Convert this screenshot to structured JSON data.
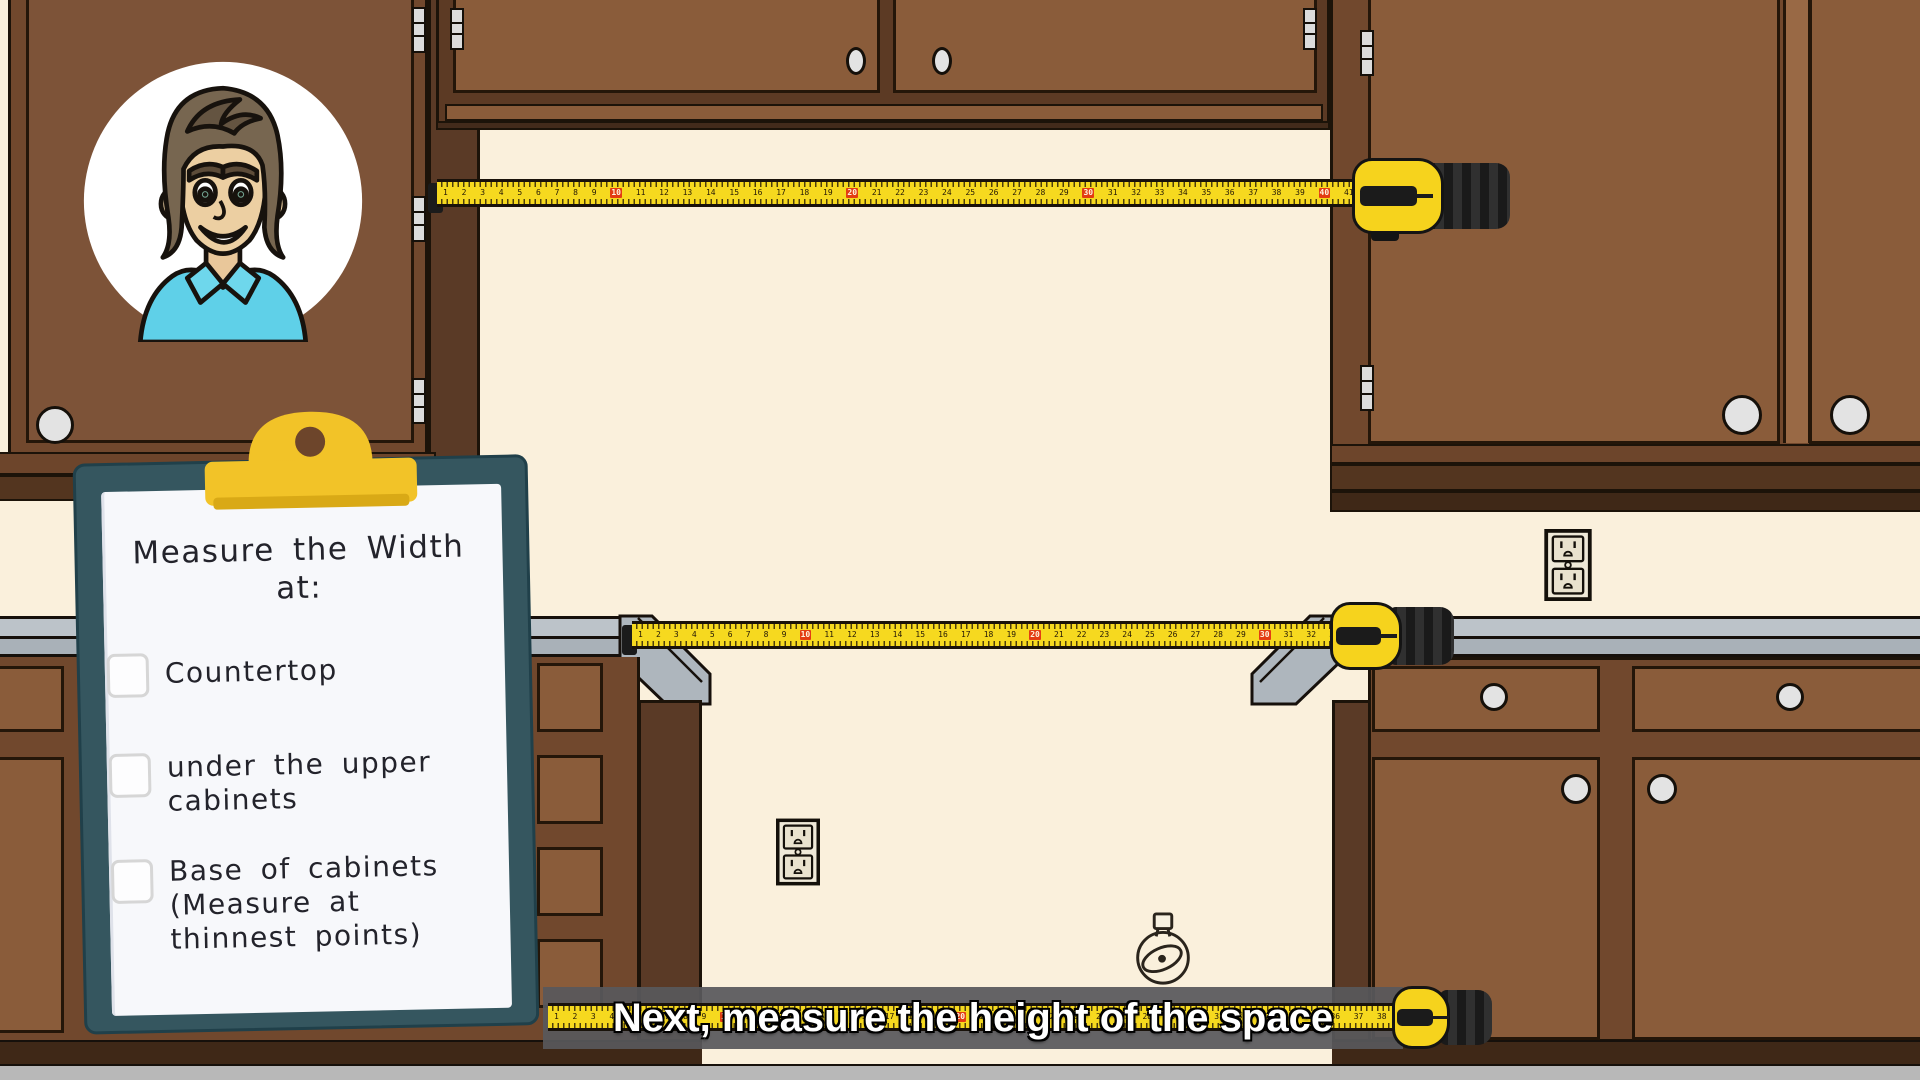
{
  "caption": {
    "text": "Next, measure the height of the space"
  },
  "clipboard": {
    "title": "Measure the Width",
    "title_suffix": "at:",
    "items": [
      {
        "label": "Countertop",
        "checked": false
      },
      {
        "label": "under the upper cabinets",
        "checked": false
      },
      {
        "label": "Base of cabinets (Measure at thinnest points)",
        "checked": false
      }
    ]
  },
  "tapes": {
    "top": {
      "count": 41,
      "red_square_interval": 10
    },
    "middle": {
      "count": 33,
      "red_square_interval": 10
    },
    "bottom": {
      "count": 38,
      "red_square_interval": 10
    }
  },
  "avatar": {
    "alt": "Cartoon presenter with brown hair and light blue collared shirt"
  },
  "colors": {
    "wall": "#faf0dc",
    "cabinet_frame": "#71482d",
    "cabinet_door": "#8a5c3a",
    "countertop_gray": "#aeb6bd",
    "tape_yellow": "#f6d91f",
    "tape_red_mark": "#e33c12",
    "clipboard_teal": "#35565f",
    "clip_yellow": "#f2c328",
    "caption_background": "#58585b",
    "floor_gray": "#b8b8b8"
  }
}
